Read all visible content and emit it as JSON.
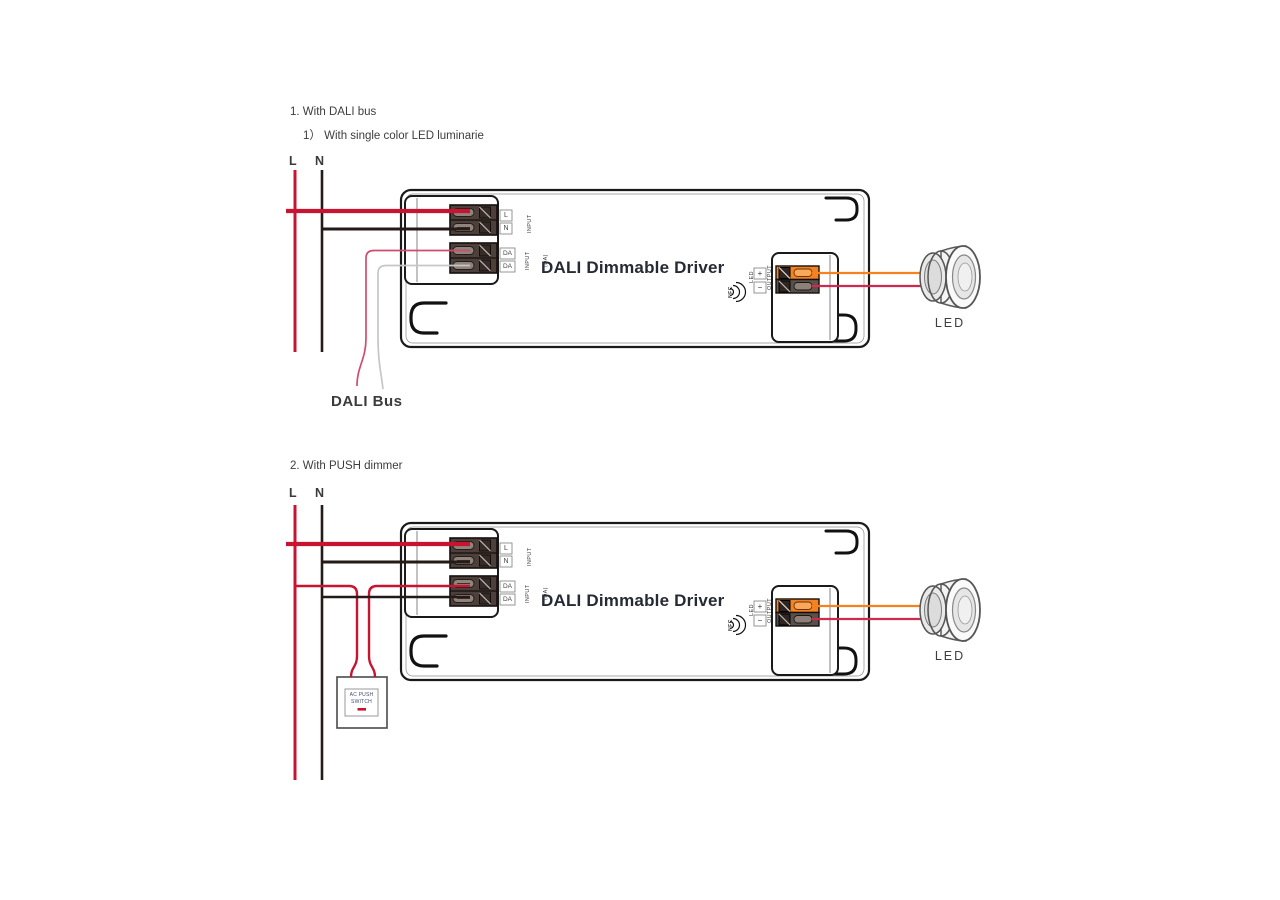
{
  "diagram1": {
    "heading": "1. With DALI bus",
    "subheading": "1） With single color LED luminarie",
    "line_live": "L",
    "line_neutral": "N",
    "dali_bus_label": "DALI Bus",
    "led_label": "LED"
  },
  "diagram2": {
    "heading": "2. With PUSH dimmer",
    "line_live": "L",
    "line_neutral": "N",
    "switch_line1": "AC PUSH",
    "switch_line2": "SWITCH",
    "led_label": "LED"
  },
  "driver": {
    "title": "DALI Dimmable Driver",
    "terminal_l": "L",
    "terminal_n": "N",
    "terminal_da1": "DA",
    "terminal_da2": "DA",
    "input_label": "INPUT",
    "dali_input_line1": "INPUT",
    "dali_input_line2": "(DA)",
    "output_plus": "+",
    "output_minus": "−",
    "output_label_line1": "LED",
    "output_label_line2": "OUTPUT",
    "nfc_label": "NFC"
  },
  "colors": {
    "wire_live": "#c81430",
    "wire_neutral": "#241b18",
    "wire_dali_a": "#d14b70",
    "wire_dali_b": "#c6c6c6",
    "wire_led_plus": "#f5821f",
    "wire_led_minus": "#d02950",
    "terminal_orange": "#f58220",
    "switch_indicator": "#c81430"
  }
}
